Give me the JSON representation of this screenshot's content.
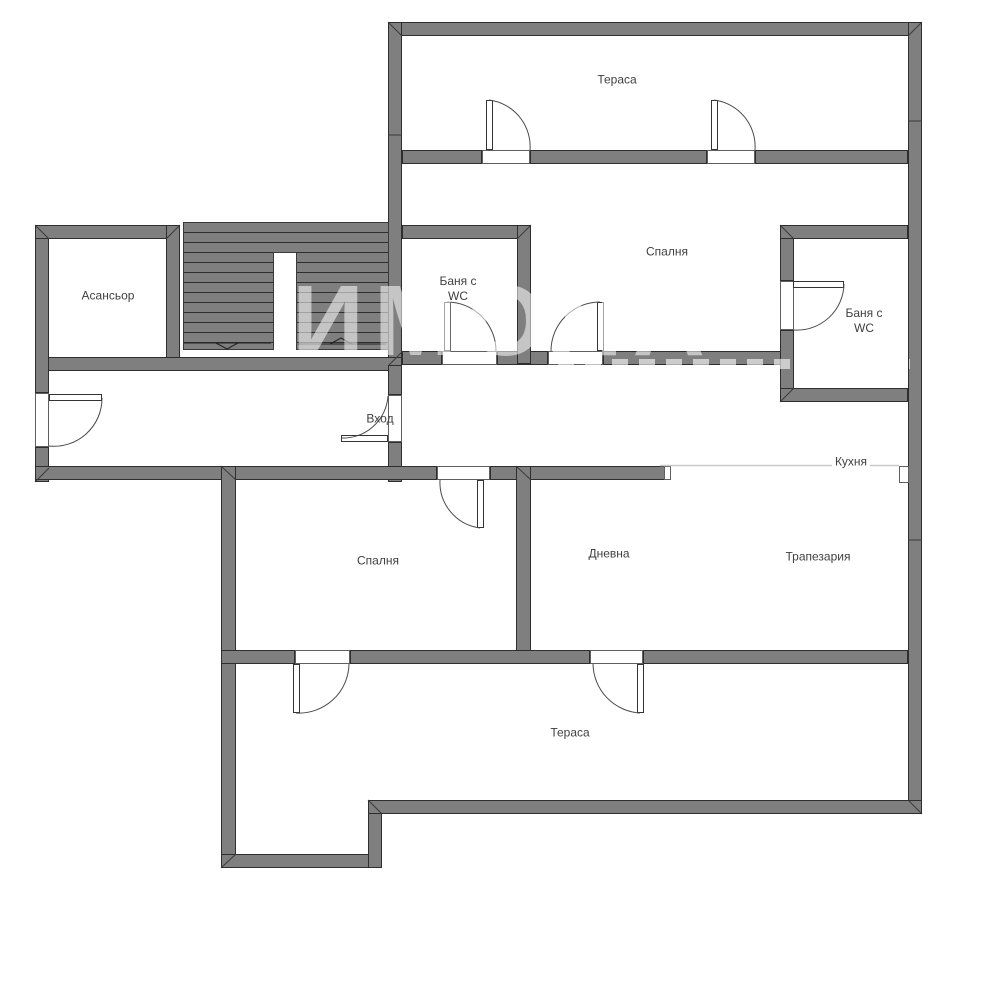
{
  "meta": {
    "type": "apartment-floor-plan",
    "width": 1000,
    "height": 985,
    "background": "#ffffff"
  },
  "palette": {
    "wall_fill": "#7f7f7f",
    "wall_outline": "#2e2e2e",
    "label_color": "#3f3f3f",
    "watermark_color": "rgba(255,255,255,0.55)",
    "area_divider_line": "#c9c9c9"
  },
  "watermark": {
    "text": "ИМОЛА"
  },
  "rooms": [
    {
      "id": "terrace-top",
      "text": "Тераса",
      "x": 617,
      "y": 80
    },
    {
      "id": "elevator",
      "text": "Асансьор",
      "x": 108,
      "y": 296
    },
    {
      "id": "bath-wc-left",
      "text": "Баня с\nWC",
      "x": 458,
      "y": 289
    },
    {
      "id": "bedroom-top",
      "text": "Спалня",
      "x": 667,
      "y": 252
    },
    {
      "id": "bath-wc-right",
      "text": "Баня с\nWC",
      "x": 864,
      "y": 321
    },
    {
      "id": "entrance",
      "text": "Вход",
      "x": 380,
      "y": 419
    },
    {
      "id": "kitchen",
      "text": "Кухня",
      "x": 851,
      "y": 462,
      "bg": true
    },
    {
      "id": "bedroom-bottom",
      "text": "Спалня",
      "x": 378,
      "y": 561
    },
    {
      "id": "living-room",
      "text": "Дневна",
      "x": 609,
      "y": 554
    },
    {
      "id": "dining-room",
      "text": "Трапезария",
      "x": 818,
      "y": 557
    },
    {
      "id": "terrace-bottom",
      "text": "Тераса",
      "x": 570,
      "y": 733
    }
  ],
  "floorplan": {
    "walls": [
      [
        388,
        22,
        534,
        14
      ],
      [
        908,
        22,
        14,
        792
      ],
      [
        388,
        22,
        14,
        342
      ],
      [
        402,
        150,
        80,
        14
      ],
      [
        530,
        150,
        177,
        14
      ],
      [
        755,
        150,
        153,
        14
      ],
      [
        35,
        357,
        367,
        14
      ],
      [
        402,
        351,
        40,
        14
      ],
      [
        497,
        351,
        51,
        14
      ],
      [
        603,
        351,
        191,
        14
      ],
      [
        388,
        365,
        14,
        30
      ],
      [
        388,
        442,
        14,
        40
      ],
      [
        35,
        225,
        14,
        168
      ],
      [
        35,
        447,
        14,
        35
      ],
      [
        35,
        225,
        145,
        14
      ],
      [
        166,
        225,
        14,
        133
      ],
      [
        402,
        225,
        129,
        14
      ],
      [
        517,
        225,
        14,
        139
      ],
      [
        780,
        225,
        14,
        56
      ],
      [
        780,
        330,
        14,
        72
      ],
      [
        780,
        225,
        128,
        14
      ],
      [
        780,
        388,
        128,
        14
      ],
      [
        35,
        466,
        402,
        14
      ],
      [
        490,
        466,
        180,
        14
      ],
      [
        221,
        466,
        15,
        402
      ],
      [
        516,
        466,
        15,
        198
      ],
      [
        221,
        650,
        74,
        14
      ],
      [
        350,
        650,
        240,
        14
      ],
      [
        643,
        650,
        265,
        14
      ],
      [
        221,
        854,
        161,
        14
      ],
      [
        368,
        800,
        14,
        68
      ],
      [
        368,
        800,
        554,
        14
      ]
    ],
    "stairs": {
      "block": [
        183,
        222,
        206,
        128
      ],
      "gap": [
        273,
        252,
        24,
        98
      ]
    },
    "openings": [
      [
        482,
        150,
        48,
        14
      ],
      [
        707,
        150,
        48,
        14
      ],
      [
        442,
        351,
        55,
        14
      ],
      [
        548,
        351,
        55,
        14
      ],
      [
        780,
        281,
        14,
        49
      ],
      [
        388,
        395,
        14,
        47
      ],
      [
        35,
        393,
        14,
        54
      ],
      [
        437,
        466,
        53,
        14
      ],
      [
        295,
        650,
        55,
        14
      ],
      [
        590,
        650,
        53,
        14
      ],
      [
        664,
        466,
        7,
        14
      ],
      [
        899,
        466,
        10,
        17
      ]
    ],
    "leaves": [
      [
        486,
        100,
        7,
        50
      ],
      [
        711,
        100,
        7,
        50
      ],
      [
        444,
        302,
        7,
        49
      ],
      [
        597,
        302,
        7,
        49
      ],
      [
        793,
        281,
        51,
        7
      ],
      [
        341,
        435,
        47,
        7
      ],
      [
        49,
        394,
        53,
        7
      ],
      [
        477,
        480,
        7,
        48
      ],
      [
        293,
        664,
        7,
        49
      ],
      [
        637,
        664,
        7,
        49
      ]
    ],
    "door_arcs": [
      [
        489,
        100,
        47,
        530,
        150,
        1
      ],
      [
        714,
        100,
        47,
        755,
        150,
        1
      ],
      [
        447,
        302,
        49,
        496,
        351,
        1
      ],
      [
        600,
        302,
        49,
        551,
        351,
        0
      ],
      [
        844,
        284,
        47,
        794,
        330,
        1
      ],
      [
        341,
        438,
        45,
        388,
        396,
        0
      ],
      [
        102,
        398,
        48,
        49,
        446,
        1
      ],
      [
        480,
        528,
        46,
        440,
        480,
        1
      ],
      [
        296,
        713,
        50,
        349,
        664,
        0
      ],
      [
        640,
        713,
        50,
        593,
        664,
        1
      ]
    ],
    "corner_miters": [
      [
        388,
        22,
        402,
        36
      ],
      [
        922,
        22,
        908,
        36
      ],
      [
        35,
        225,
        49,
        239
      ],
      [
        180,
        225,
        166,
        239
      ],
      [
        35,
        482,
        49,
        468
      ],
      [
        221,
        466,
        236,
        480
      ],
      [
        516,
        466,
        531,
        480
      ],
      [
        221,
        868,
        236,
        854
      ],
      [
        368,
        800,
        382,
        814
      ],
      [
        922,
        814,
        908,
        800
      ],
      [
        531,
        225,
        517,
        239
      ],
      [
        780,
        225,
        794,
        239
      ],
      [
        780,
        402,
        794,
        388
      ],
      [
        403,
        351,
        389,
        365
      ]
    ],
    "wall_seams": [
      [
        908,
        121,
        922,
        121
      ],
      [
        908,
        540,
        922,
        540
      ],
      [
        388,
        135,
        402,
        135
      ]
    ],
    "stair_arrows": [
      "M184,343 L271,343 M216,343 L227,349 L238,343",
      "M298,344 L386,344 M330,344 L341,338 L352,344"
    ],
    "area_divider": [
      660,
      465.5,
      899,
      465.5
    ]
  }
}
